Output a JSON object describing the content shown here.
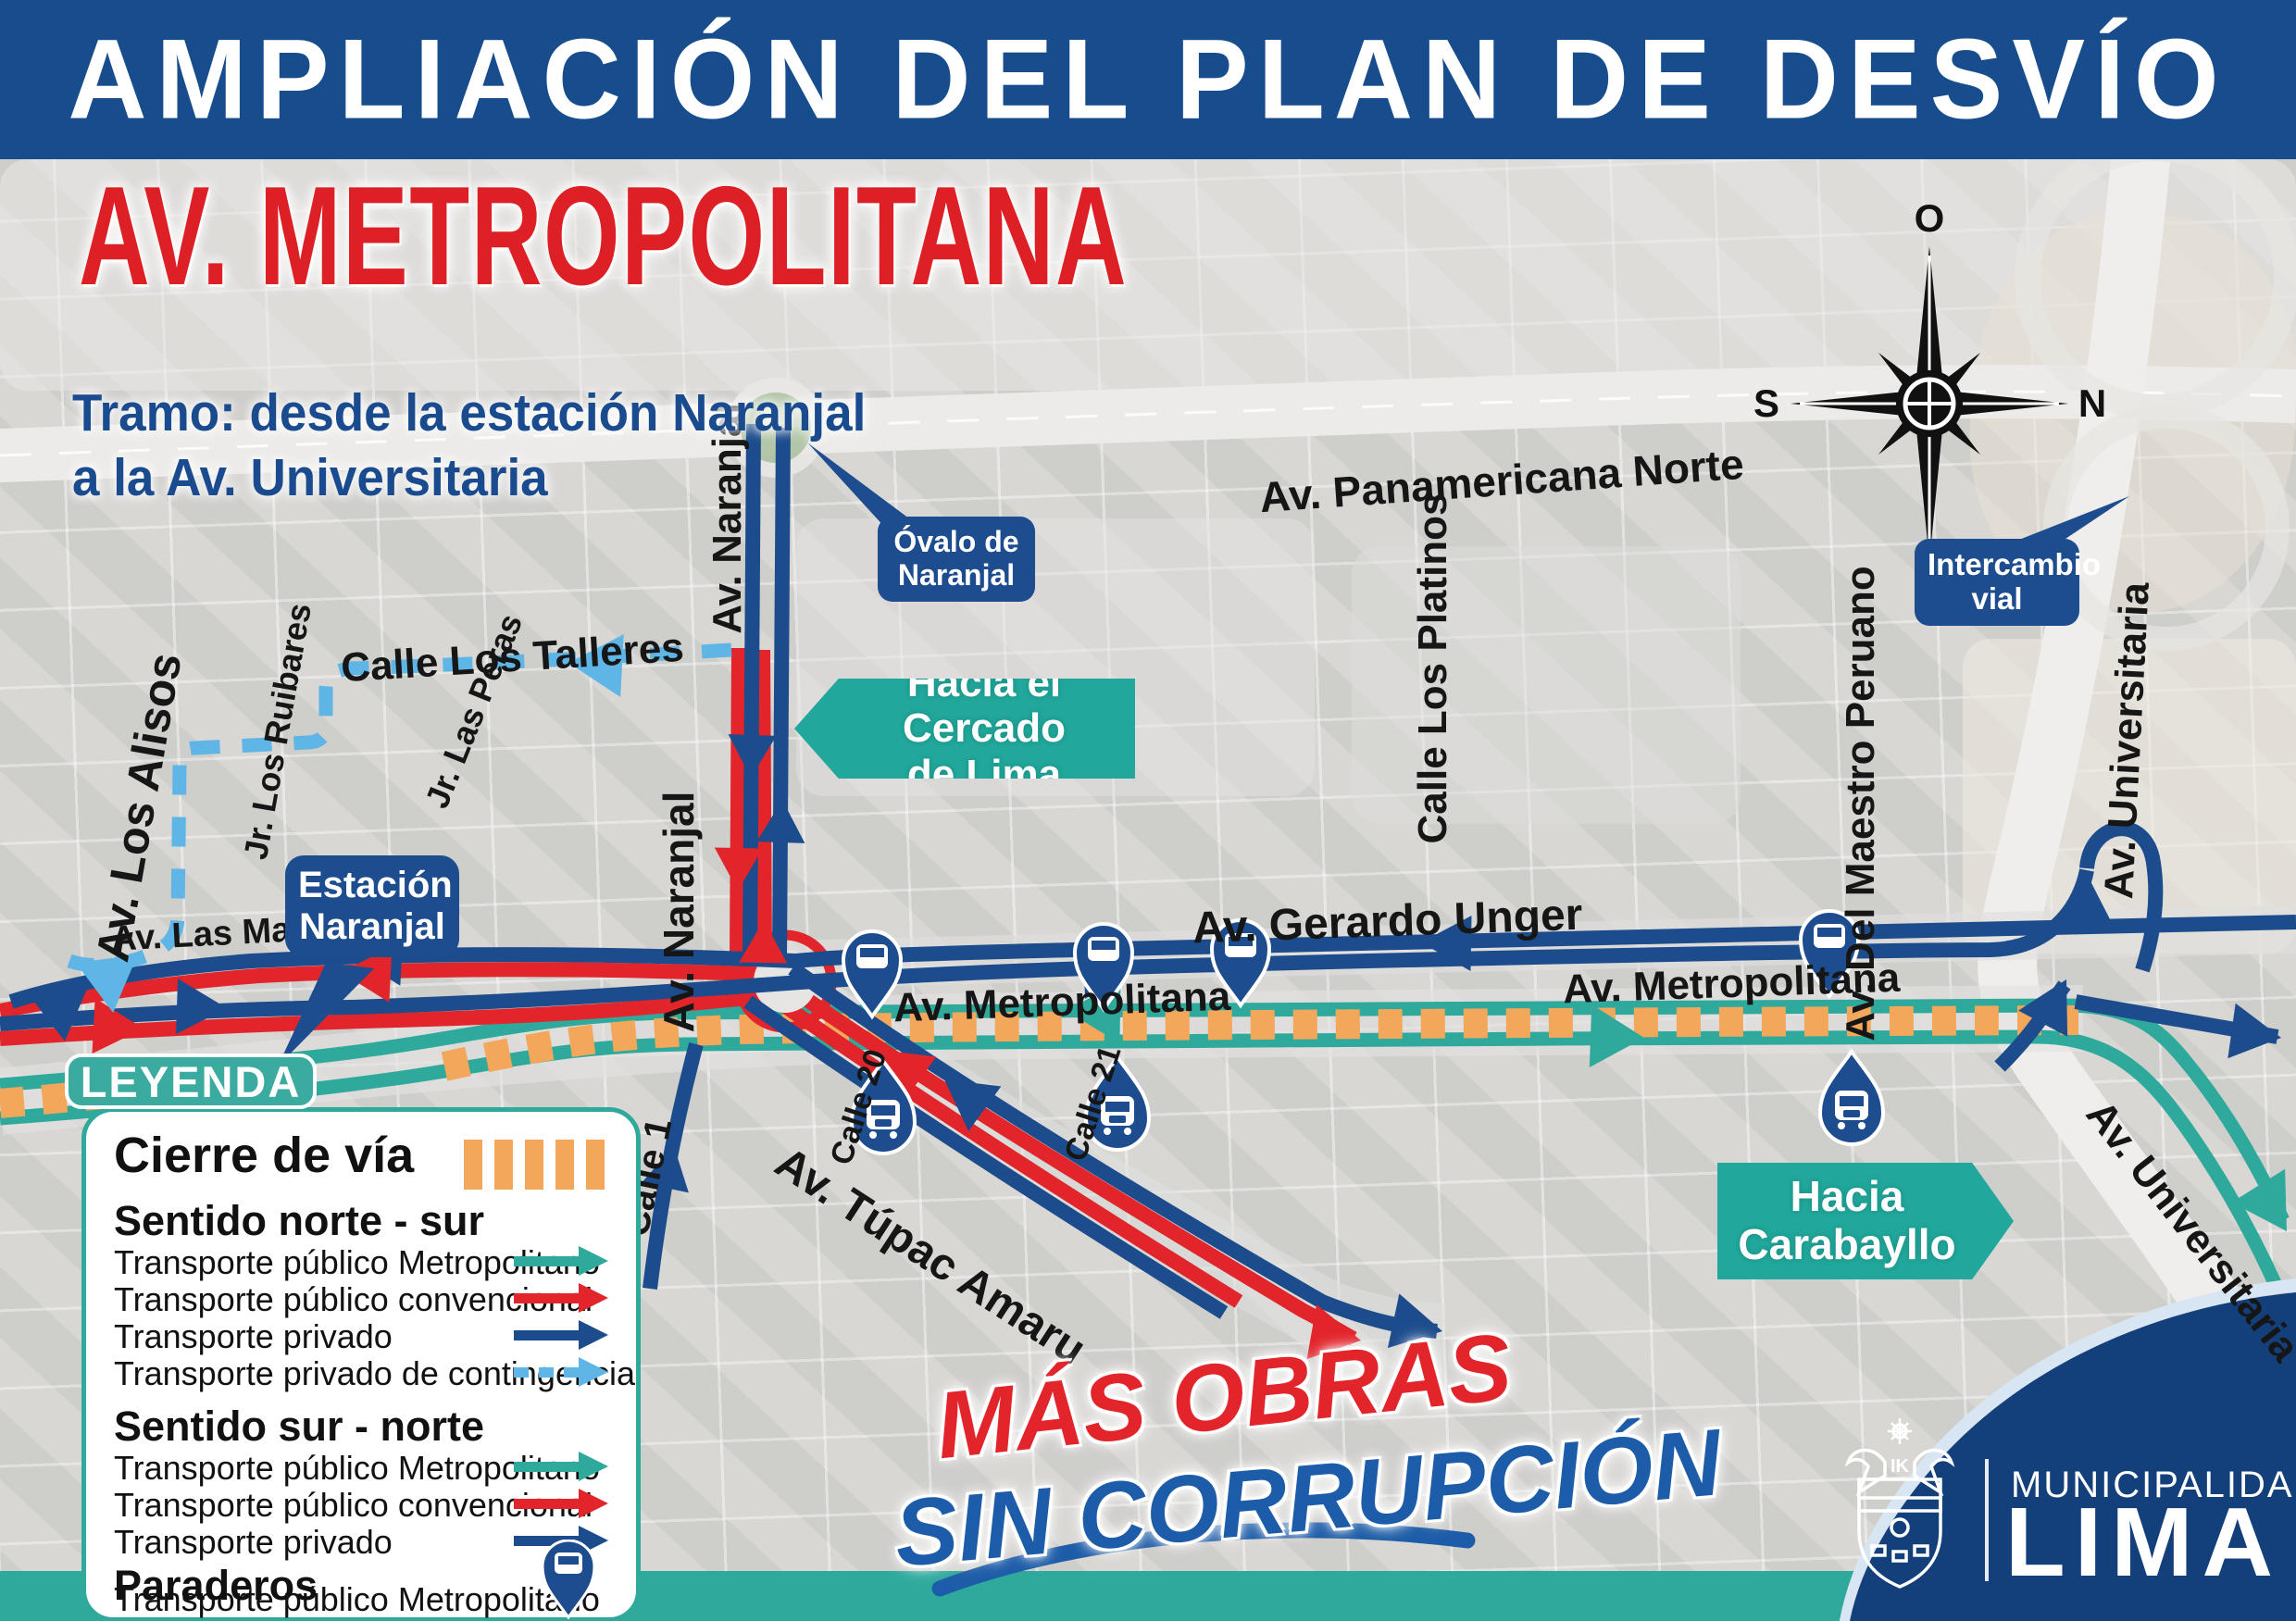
{
  "colors": {
    "banner_blue": "#174d8c",
    "title_red": "#dd1f26",
    "subtitle_blue": "#1b4b8f",
    "teal": "#21a79b",
    "route_teal": "#2ea99c",
    "route_red": "#e2242b",
    "route_dark_blue": "#1c4c8c",
    "route_light_blue": "#5fb6e6",
    "closure_orange": "#f2a75b",
    "callout_navy": "#1d4c8f",
    "footer_navy": "#133f7b"
  },
  "header": {
    "banner": "AMPLIACIÓN DEL PLAN DE DESVÍO",
    "title": "AV. METROPOLITANA",
    "subtitle_line1": "Tramo: desde la estación Naranjal",
    "subtitle_line2": "a la Av. Universitaria"
  },
  "compass": {
    "top": "O",
    "right": "N",
    "left": "S",
    "bottom": "E"
  },
  "map": {
    "streets": [
      {
        "text": "Av. Panamericana Norte"
      },
      {
        "text": "Calle Los Talleres"
      },
      {
        "text": "Av. Los Alisos"
      },
      {
        "text": "Jr. Los Ruibares"
      },
      {
        "text": "Jr. Las Peras"
      },
      {
        "text": "Av. Las Maracuyás"
      },
      {
        "text": "Av. Naranjal"
      },
      {
        "text": "Av. Naranjal"
      },
      {
        "text": "Calle Los Platinos"
      },
      {
        "text": "Av. Del Maestro Peruano"
      },
      {
        "text": "Av. Universitaria"
      },
      {
        "text": "Av. Universitaria"
      },
      {
        "text": "Av. Gerardo Unger"
      },
      {
        "text": "Av. Metropolitana"
      },
      {
        "text": "Av. Metropolitana"
      },
      {
        "text": "Calle 20"
      },
      {
        "text": "Calle 21"
      },
      {
        "text": "Calle 1"
      },
      {
        "text": "Av. Túpac Amaru"
      }
    ],
    "callouts": {
      "ovalo": {
        "line1": "Óvalo de",
        "line2": "Naranjal"
      },
      "estacion": {
        "line1": "Estación",
        "line2": "Naranjal"
      },
      "intercambio": {
        "line1": "Intercambio",
        "line2": "vial"
      },
      "cercado": {
        "line1": "Hacia el Cercado",
        "line2": "de Lima"
      },
      "carabayllo": {
        "line1": "Hacia",
        "line2": "Carabayllo"
      }
    }
  },
  "legend": {
    "tab": "LEYENDA",
    "closure_label": "Cierre de vía",
    "north_south": {
      "title": "Sentido norte - sur",
      "items": [
        {
          "label": "Transporte público Metropolitano",
          "color": "#2ea99c",
          "style": "solid"
        },
        {
          "label": "Transporte público convencional",
          "color": "#e2242b",
          "style": "solid"
        },
        {
          "label": "Transporte privado",
          "color": "#1c4c8c",
          "style": "solid"
        },
        {
          "label": "Transporte privado de contingencia",
          "color": "#5fb6e6",
          "style": "dashed"
        }
      ]
    },
    "south_north": {
      "title": "Sentido sur - norte",
      "items": [
        {
          "label": "Transporte público Metropolitano",
          "color": "#2ea99c",
          "style": "solid"
        },
        {
          "label": "Transporte público convencional",
          "color": "#e2242b",
          "style": "solid"
        },
        {
          "label": "Transporte privado",
          "color": "#1c4c8c",
          "style": "solid"
        }
      ]
    },
    "paraderos": {
      "title": "Paraderos",
      "items": [
        {
          "label": "Transporte público Metropolitano",
          "icon": "bus-stop-pin"
        }
      ]
    }
  },
  "slogan": {
    "line1": "MÁS OBRAS",
    "line2": "SIN CORRUPCIÓN"
  },
  "footer": {
    "org_line1": "MUNICIPALIDAD DE",
    "org_line2": "LIMA"
  }
}
